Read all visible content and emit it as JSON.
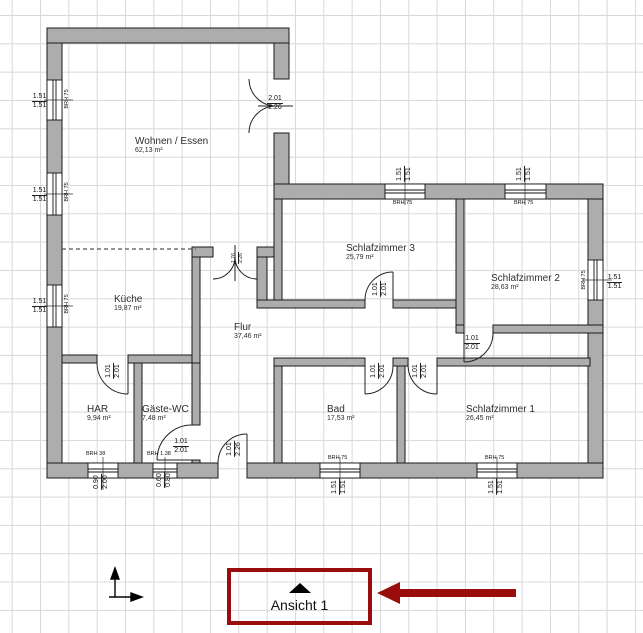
{
  "drawing": {
    "rooms": [
      {
        "name": "Wohnen / Essen",
        "area": "62,13 m²"
      },
      {
        "name": "Küche",
        "area": "19,87 m²"
      },
      {
        "name": "Flur",
        "area": "37,46 m²"
      },
      {
        "name": "HAR",
        "area": "9,94 m²"
      },
      {
        "name": "Gäste-WC",
        "area": "7,48 m²"
      },
      {
        "name": "Bad",
        "area": "17,53 m²"
      },
      {
        "name": "Schlafzimmer 1",
        "area": "26,45 m²"
      },
      {
        "name": "Schlafzimmer 2",
        "area": "28,63 m²"
      },
      {
        "name": "Schlafzimmer 3",
        "area": "25,79 m²"
      }
    ],
    "windows": [
      {
        "width_label": "1.51",
        "height_label": "1.51",
        "brh": "BRH 75"
      },
      {
        "width_label": "1.51",
        "height_label": "1.51",
        "brh": "BRH 75"
      },
      {
        "width_label": "1.51",
        "height_label": "1.51",
        "brh": "BRH 75"
      },
      {
        "width_label": "1.51",
        "height_label": "1.51",
        "brh": "BRH 75"
      },
      {
        "width_label": "1.51",
        "height_label": "1.51",
        "brh": "BRH 75"
      },
      {
        "width_label": "1.51",
        "height_label": "1.51",
        "brh": "BRH 75"
      },
      {
        "width_label": "1.51",
        "height_label": "1.51",
        "brh": "BRH 75"
      },
      {
        "width_label": "1.51",
        "height_label": "1.51",
        "brh": "BRH 75"
      },
      {
        "width_label": "0.90",
        "height_label": "2.00",
        "brh": "BRH 38"
      },
      {
        "width_label": "0.60",
        "height_label": "0.80",
        "brh": "BRH 1.38"
      }
    ],
    "doors": [
      {
        "width_label": "2.01",
        "height_label": "2.26"
      },
      {
        "width_label": "1.76",
        "height_label": "2.26"
      },
      {
        "width_label": "1.01",
        "height_label": "2.26"
      },
      {
        "width_label": "1.01",
        "height_label": "2.01"
      },
      {
        "width_label": "1.01",
        "height_label": "2.01"
      },
      {
        "width_label": "1.01",
        "height_label": "2.01"
      },
      {
        "width_label": "1.01",
        "height_label": "2.01"
      },
      {
        "width_label": "1.01",
        "height_label": "2.01"
      },
      {
        "width_label": "1.01",
        "height_label": "2.01"
      }
    ],
    "view_marker": {
      "label": "Ansicht 1"
    },
    "colors": {
      "accent_red": "#9a0d0d",
      "wall_fill": "#adadad",
      "grid": "#d8d8d8",
      "background": "#ffffff"
    }
  }
}
